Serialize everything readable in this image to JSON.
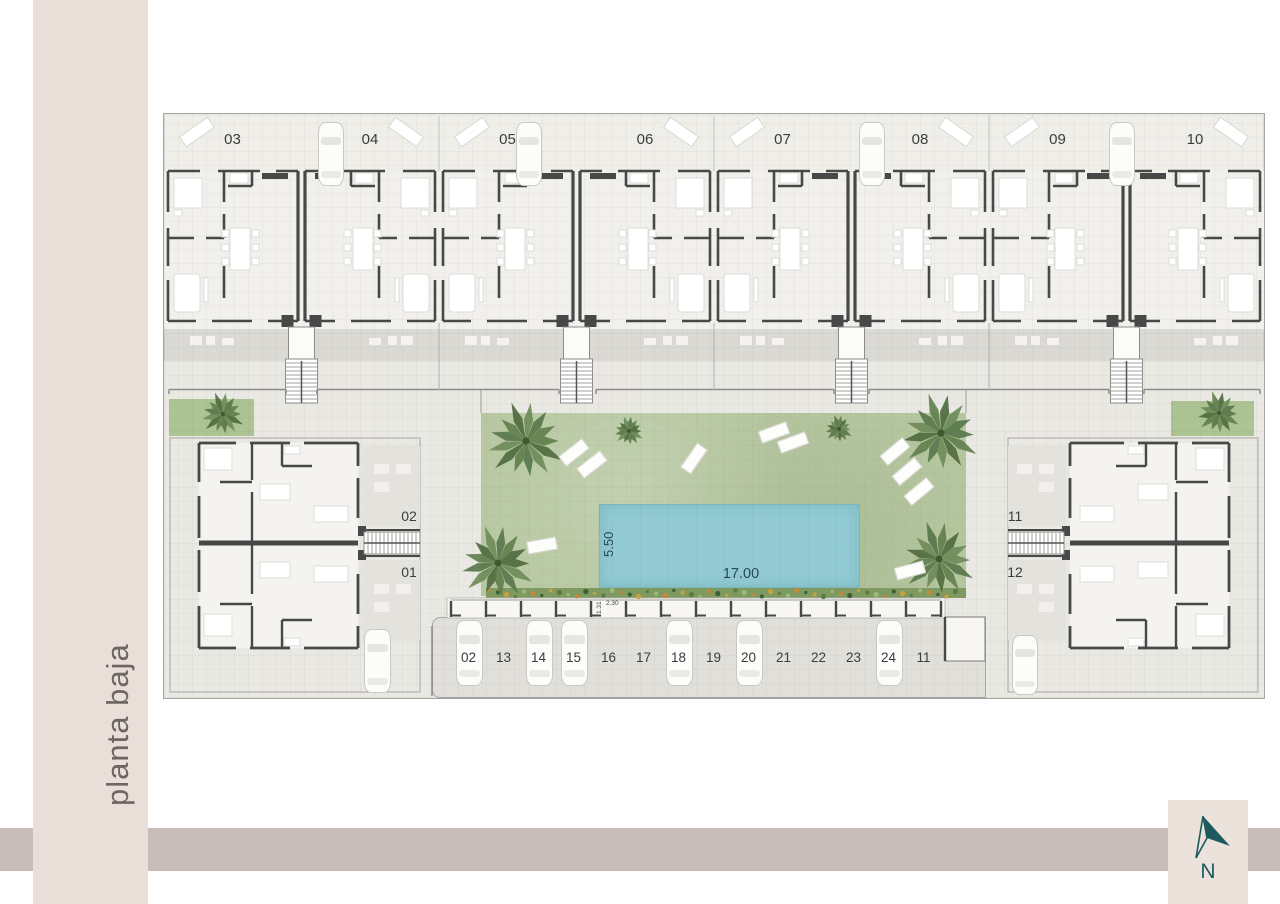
{
  "page": {
    "title_vertical": "planta baja"
  },
  "compass": {
    "letter": "N"
  },
  "top_row_units": [
    {
      "label": "03"
    },
    {
      "label": "04"
    },
    {
      "label": "05"
    },
    {
      "label": "06"
    },
    {
      "label": "07"
    },
    {
      "label": "08"
    },
    {
      "label": "09"
    },
    {
      "label": "10"
    }
  ],
  "left_block_units": [
    {
      "label": "02"
    },
    {
      "label": "01"
    }
  ],
  "right_block_units": [
    {
      "label": "11"
    },
    {
      "label": "12"
    }
  ],
  "pool": {
    "length_label": "17.00",
    "width_label": "5.50"
  },
  "parking": {
    "spaces": [
      "02",
      "13",
      "14",
      "15",
      "16",
      "17",
      "18",
      "19",
      "20",
      "21",
      "22",
      "23",
      "24",
      "11"
    ],
    "occupied_spaces": [
      "02",
      "14",
      "15",
      "18",
      "20",
      "24"
    ],
    "stall_width_label": "2.30",
    "stall_depth_label": "1.31"
  },
  "colors": {
    "pool": "#92cbd4",
    "lawn": "#b7c8a1",
    "band_left": "#e9ded8",
    "band_bottom": "#c8bcb8",
    "compass_teal": "#1d5a5e",
    "wall": "#484848"
  }
}
